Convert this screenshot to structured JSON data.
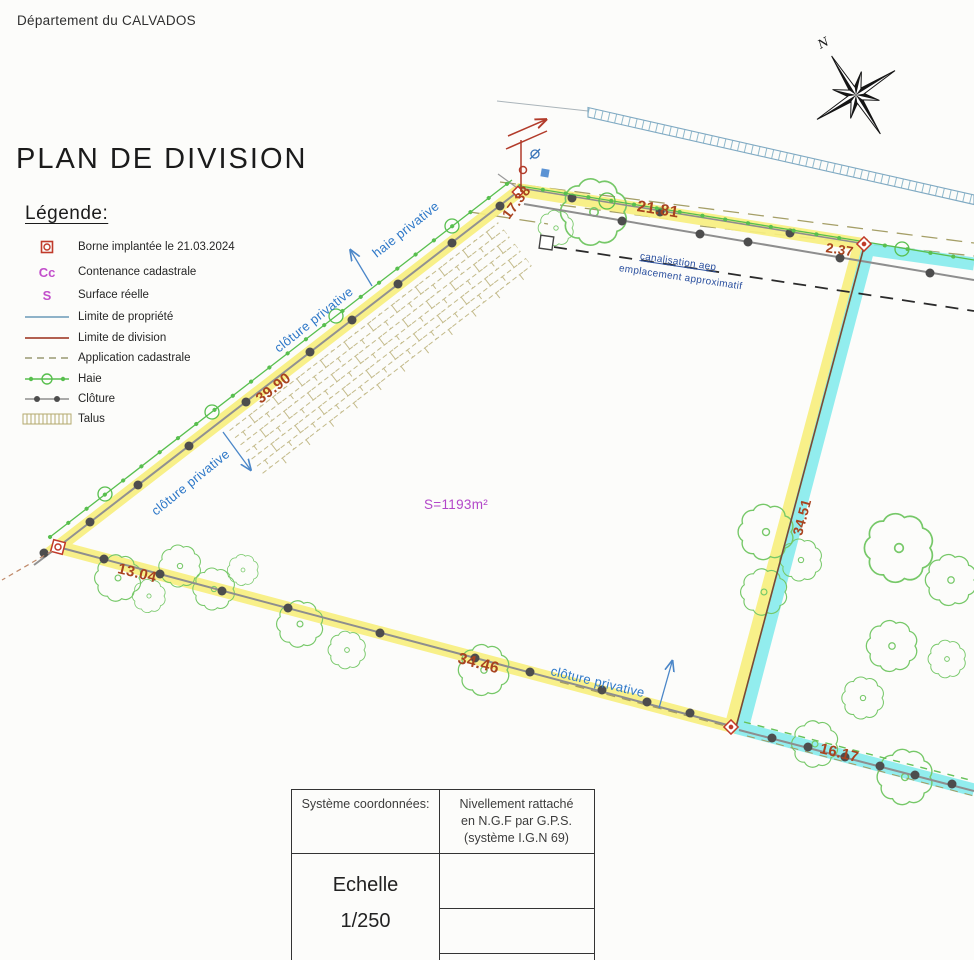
{
  "header": {
    "department": "Département du CALVADOS",
    "title": "PLAN DE DIVISION"
  },
  "legend": {
    "title": "Légende:",
    "items": [
      {
        "symbol": "borne-icon",
        "label": "Borne implantée le 21.03.2024"
      },
      {
        "symbol": "Cc",
        "label": "Contenance cadastrale"
      },
      {
        "symbol": "S",
        "label": "Surface réelle"
      },
      {
        "symbol": "blue-line",
        "label": "Limite de propriété"
      },
      {
        "symbol": "red-line",
        "label": "Limite de division"
      },
      {
        "symbol": "dashed-line",
        "label": "Application cadastrale"
      },
      {
        "symbol": "haie-line",
        "label": "Haie"
      },
      {
        "symbol": "cloture-line",
        "label": "Clôture"
      },
      {
        "symbol": "talus-hatch",
        "label": "Talus"
      }
    ]
  },
  "plan": {
    "north_label": "N",
    "surface_label": "S=1193m²",
    "measurements": {
      "top": "21.81",
      "corner_right": "2.37",
      "top_left_segment": "17.38",
      "left": "39.90",
      "bottom_left": "13.04",
      "bottom": "34.46",
      "divider": "34.51",
      "bottom_right": "16.17"
    },
    "labels": {
      "haie_privative": "haie privative",
      "cloture_privative_1": "clôture privative",
      "cloture_privative_2": "clôture privative",
      "cloture_privative_3": "clôture privative",
      "canalisation_line1": "canalisation aep",
      "canalisation_line2": "emplacement approximatif"
    }
  },
  "table": {
    "col1_header": "Système coordonnées:",
    "col2_header_line1": "Nivellement rattaché",
    "col2_header_line2": "en N.G.F par G.P.S.",
    "col2_header_line3": "(système I.G.N 69)",
    "echelle_label": "Echelle",
    "echelle_value": "1/250"
  },
  "colors": {
    "parcel_highlight": "#f7ef7f",
    "neighbor_highlight": "#86ebec",
    "measurement_red": "#a8431f",
    "label_blue": "#2e78c8",
    "surface_magenta": "#b347c9",
    "haie_green": "#58bf4e",
    "cloture_gray": "#8e8e8e"
  }
}
